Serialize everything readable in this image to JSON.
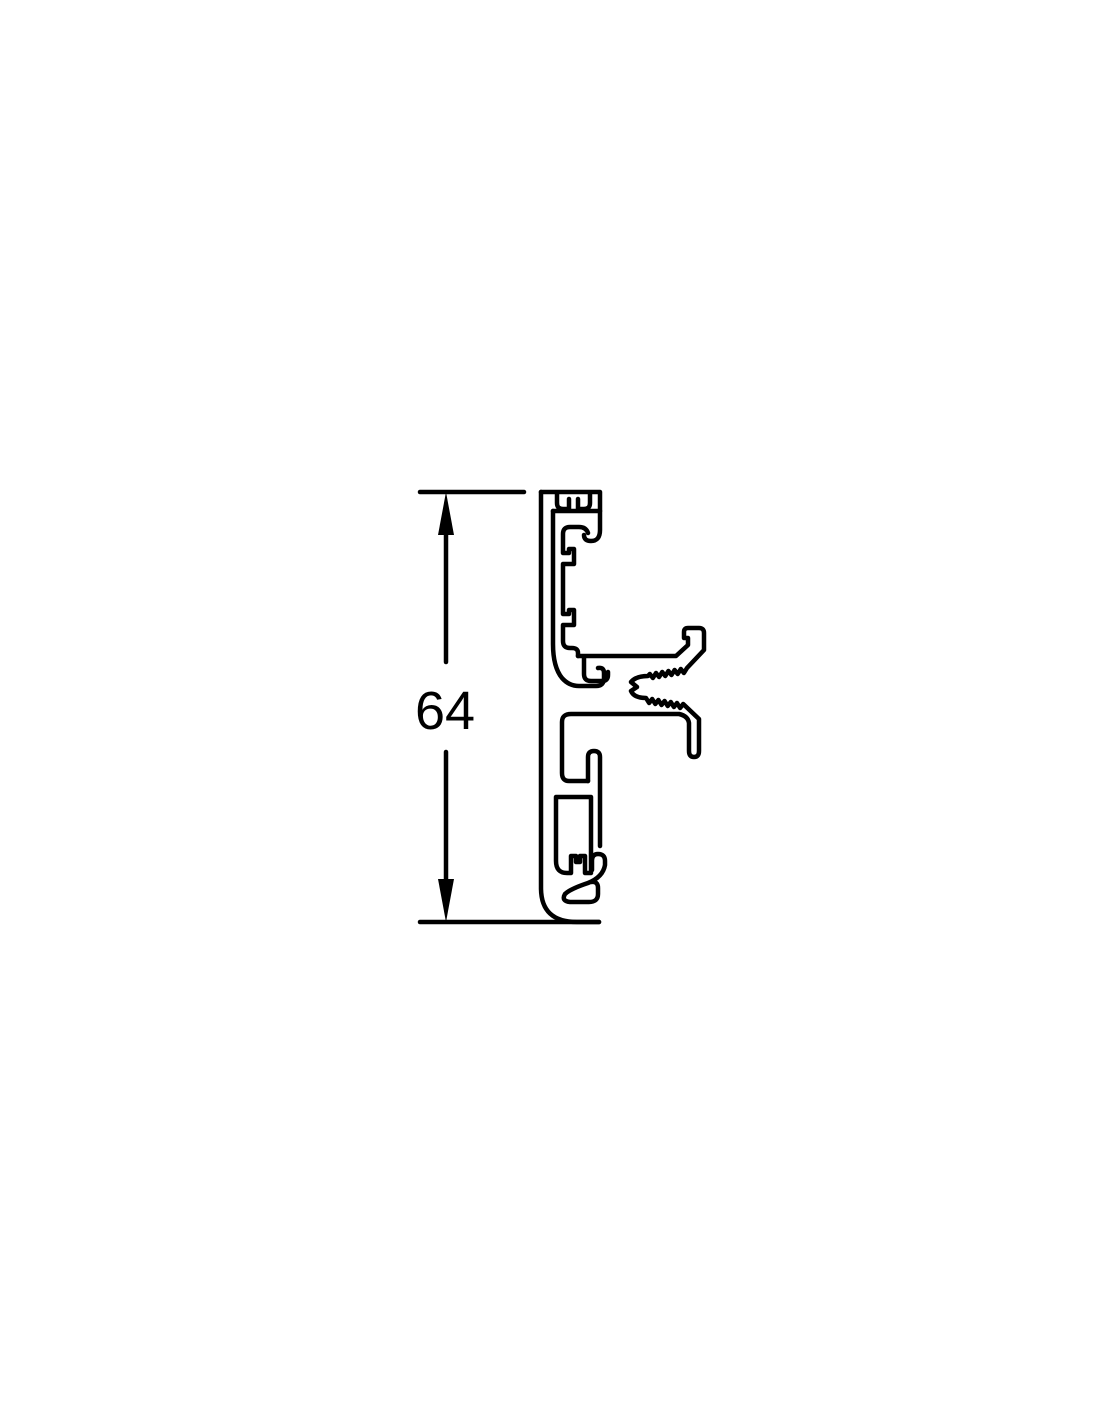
{
  "page": {
    "background_color": "#ffffff"
  },
  "drawing": {
    "line_color": "#000000",
    "dimension": {
      "label": "64"
    }
  }
}
